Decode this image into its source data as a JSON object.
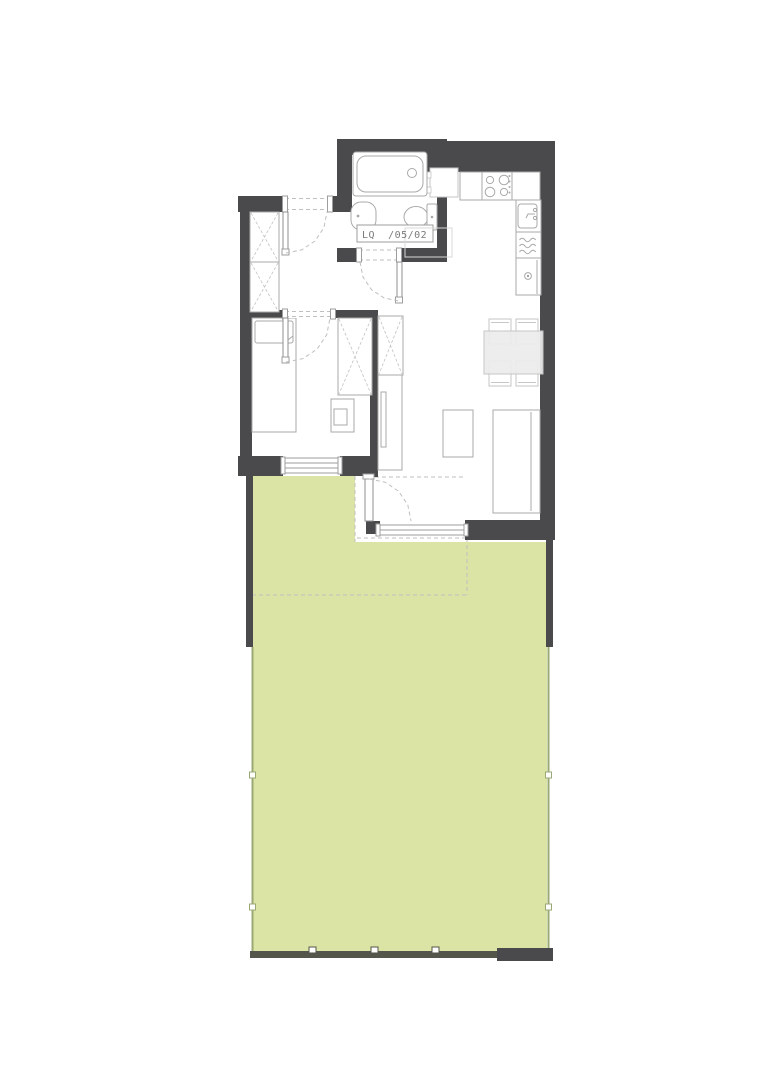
{
  "plan": {
    "unit_label": "LQ  /05/02",
    "colors": {
      "wall": "#4a4a4d",
      "garden": "#dbe4a5",
      "fence": "#9aa873",
      "fence_dark": "#54564b",
      "furniture_line": "#a9a9a9",
      "furniture_line_light": "#c6c6c6",
      "window_line": "#9e9e9e",
      "dashed_line": "#bfbfbf",
      "table_fill": "#ebebeb",
      "label_text": "#7a7a7a"
    }
  }
}
